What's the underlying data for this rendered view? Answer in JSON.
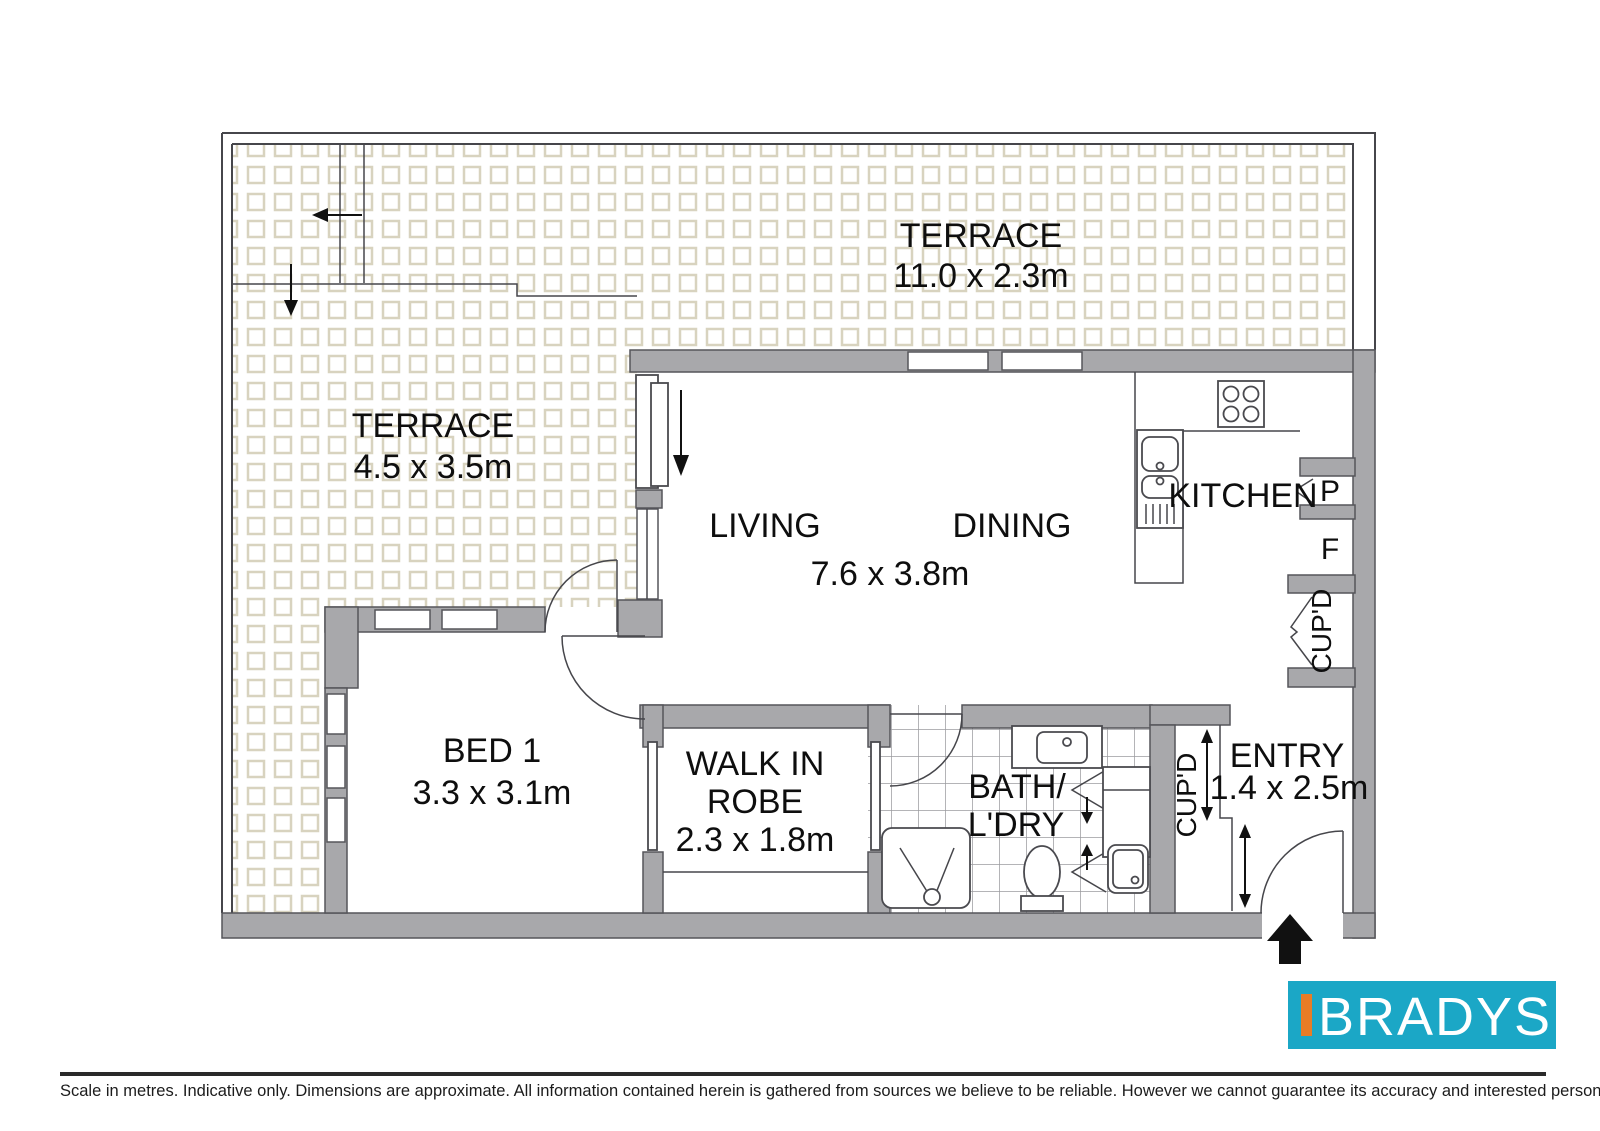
{
  "floorplan": {
    "labels": {
      "terrace_top": "TERRACE",
      "terrace_top_dims": "11.0 x 2.3m",
      "terrace_left": "TERRACE",
      "terrace_left_dims": "4.5 x 3.5m",
      "living": "LIVING",
      "dining": "DINING",
      "living_dining_dims": "7.6 x 3.8m",
      "kitchen": "KITCHEN",
      "pantry": "P",
      "fridge": "F",
      "cupd_kitchen": "CUP'D",
      "cupd_entry": "CUP'D",
      "bed1": "BED 1",
      "bed1_dims": "3.3 x 3.1m",
      "robe_line1": "WALK IN",
      "robe_line2": "ROBE",
      "robe_dims": "2.3 x 1.8m",
      "bath_line1": "BATH/",
      "bath_line2": "L'DRY",
      "entry": "ENTRY",
      "entry_dims": "1.4 x 2.5m"
    },
    "colors": {
      "wall_gray": "#a8a8ab",
      "tile_outline": "#d8d3bf",
      "bath_grid": "#9b9b9f"
    }
  },
  "branding": {
    "logo_text": "BRADYS",
    "logo_bg": "#1ba7c6",
    "logo_accent": "#e87c26"
  },
  "footer": {
    "disclaimer": "Scale in metres. Indicative only. Dimensions are approximate. All information contained herein is gathered from sources we believe to be reliable. However we cannot guarantee its accuracy and interested persons should rely on their own enquiries."
  }
}
